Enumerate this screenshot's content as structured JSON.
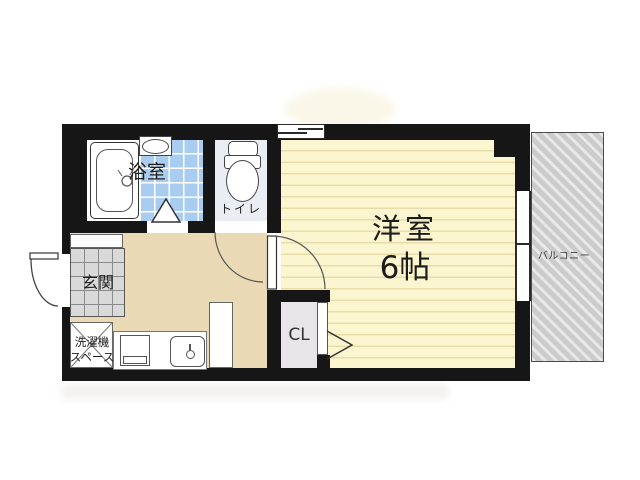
{
  "rooms": {
    "bathroom": {
      "label": "浴室"
    },
    "toilet": {
      "label": "トイレ"
    },
    "entrance": {
      "label": "玄関"
    },
    "laundry": {
      "line1": "洗濯機",
      "line2": "スペース"
    },
    "closet": {
      "label": "CL"
    },
    "main_room": {
      "name": "洋室",
      "size": "6帖"
    },
    "balcony": {
      "label": "バルコニー"
    }
  },
  "colors": {
    "wall": "#161616",
    "room_floor": "#fbf6cf",
    "floor_stripe": "#e9dcab",
    "hallway": "#ead9b5",
    "tile_blue": "#a9cdf1",
    "toilet_bg": "#eaedf3",
    "entrance_tile": "#d9d9d9",
    "closet_bg": "#e7e4ea",
    "balcony_gray": "#cbcbcb",
    "outline": "#333333"
  }
}
